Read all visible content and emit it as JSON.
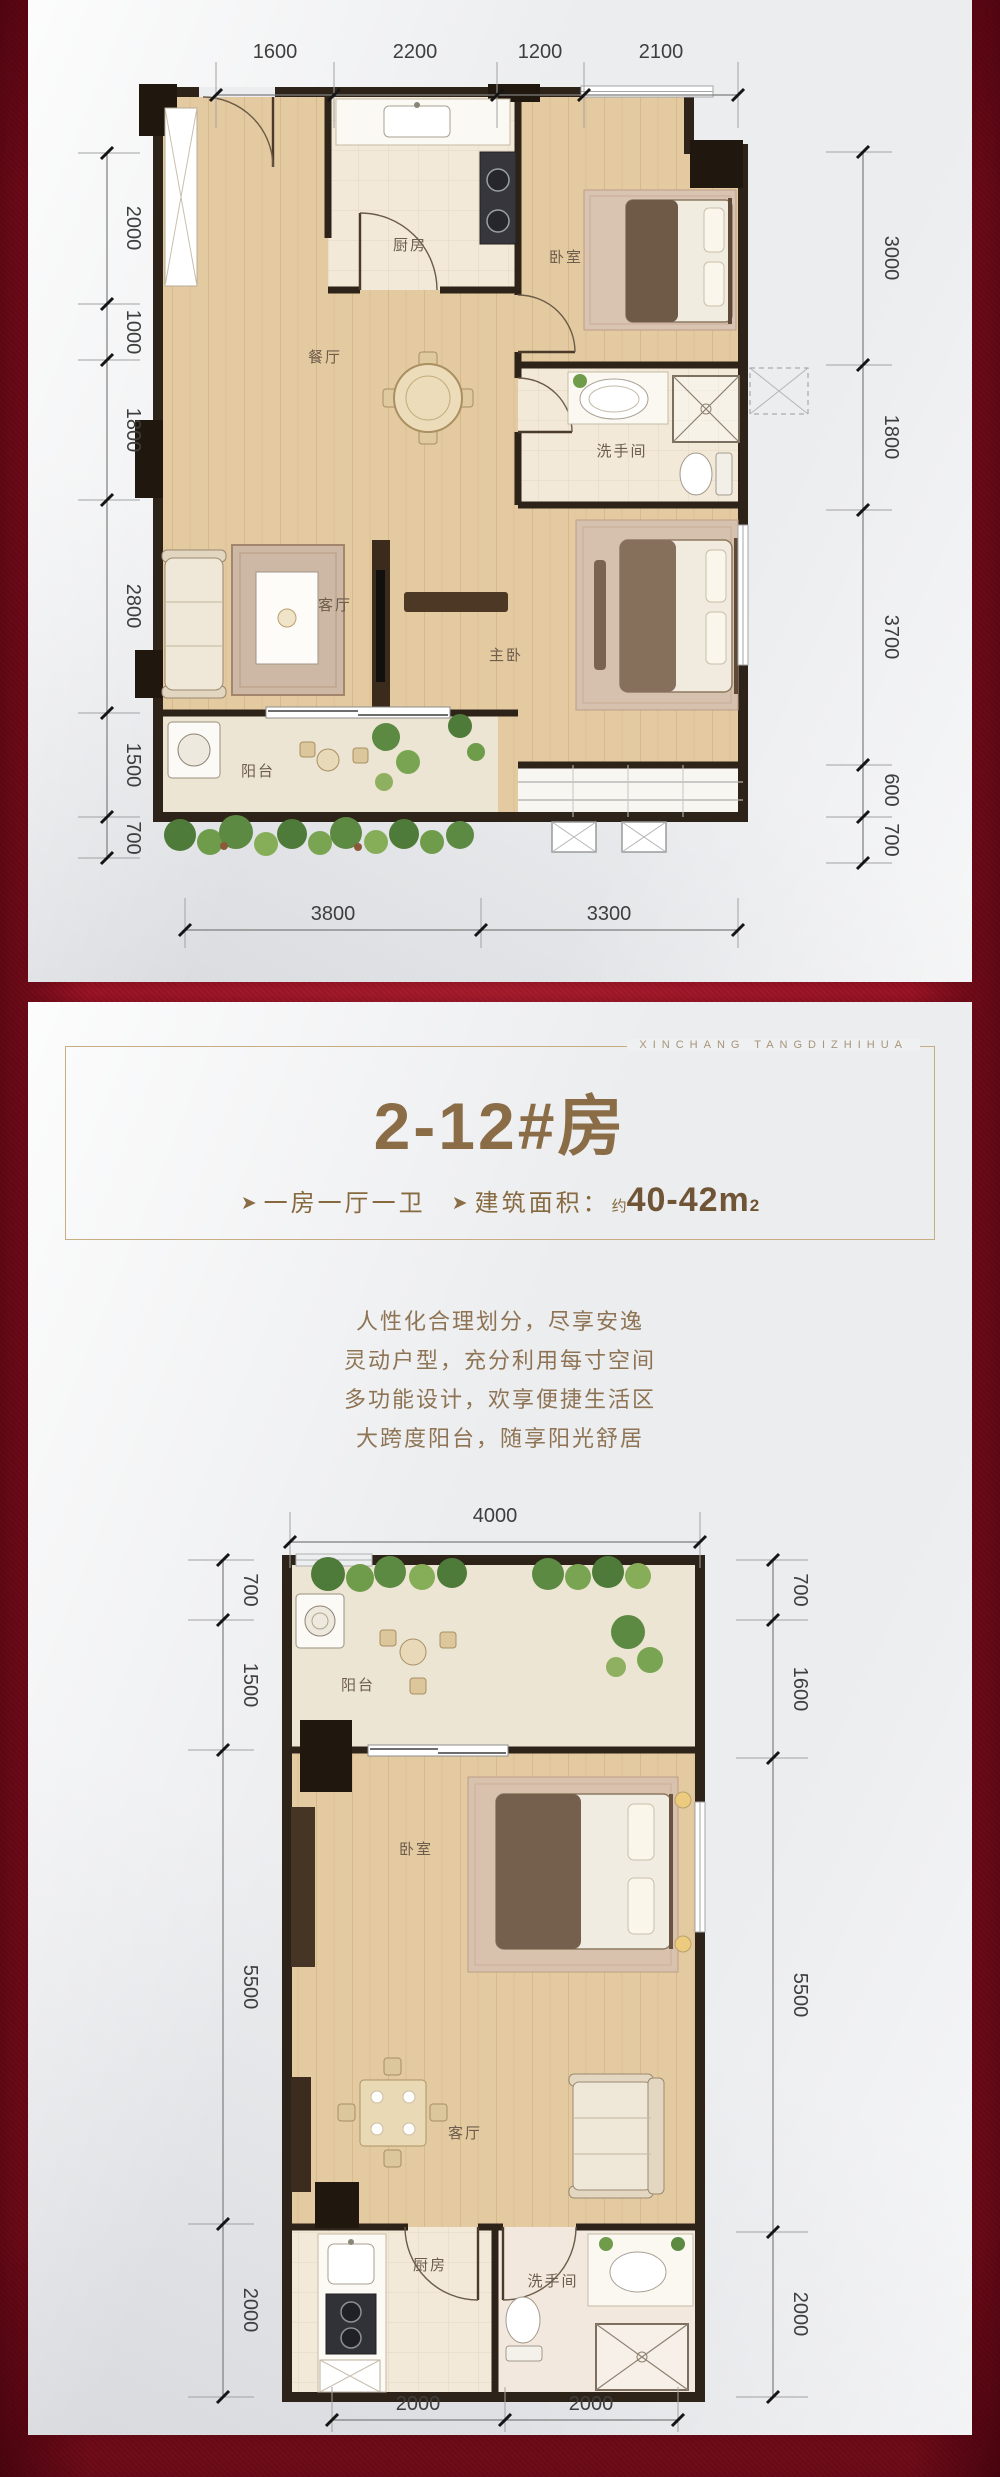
{
  "brand": {
    "watermark_text": "XINCHANG TANGDIZHIHUA"
  },
  "unit_card": {
    "title": "2-12#房",
    "feature_arrow": "➤",
    "feature_text": "一房一厅一卫",
    "area_arrow": "➤",
    "area_label": "建筑面积：",
    "area_approx": "约",
    "area_value": "40-42m",
    "area_sup": "2",
    "description_lines": [
      "人性化合理划分，尽享安逸",
      "灵动户型，充分利用每寸空间",
      "多功能设计，欢享便捷生活区",
      "大跨度阳台，随享阳光舒居"
    ]
  },
  "plan_a": {
    "dims_top": [
      "1600",
      "2200",
      "1200",
      "2100"
    ],
    "dims_left": [
      "2000",
      "1000",
      "1800",
      "2800",
      "1500",
      "700"
    ],
    "dims_right": [
      "3000",
      "1800",
      "3700",
      "600",
      "700"
    ],
    "dims_bottom": [
      "3800",
      "3300"
    ],
    "rooms": {
      "kitchen": "厨房",
      "bedroom": "卧室",
      "dining": "餐厅",
      "bathroom": "洗手间",
      "living": "客厅",
      "master_bedroom": "主卧",
      "balcony": "阳台"
    }
  },
  "plan_b": {
    "dims_top": [
      "4000"
    ],
    "dims_left": [
      "700",
      "1500",
      "5500",
      "2000"
    ],
    "dims_right": [
      "700",
      "1600",
      "5500",
      "2000"
    ],
    "dims_bottom": [
      "2000",
      "2000"
    ],
    "rooms": {
      "balcony": "阳台",
      "bedroom": "卧室",
      "living": "客厅",
      "kitchen": "厨房",
      "bathroom": "洗手间"
    }
  },
  "colors": {
    "background_red": "#9e1124",
    "panel": "#ecedef",
    "accent_gold": "#8a6c47",
    "wall_dark": "#2e2318",
    "wood_floor": "#e4caa0"
  }
}
